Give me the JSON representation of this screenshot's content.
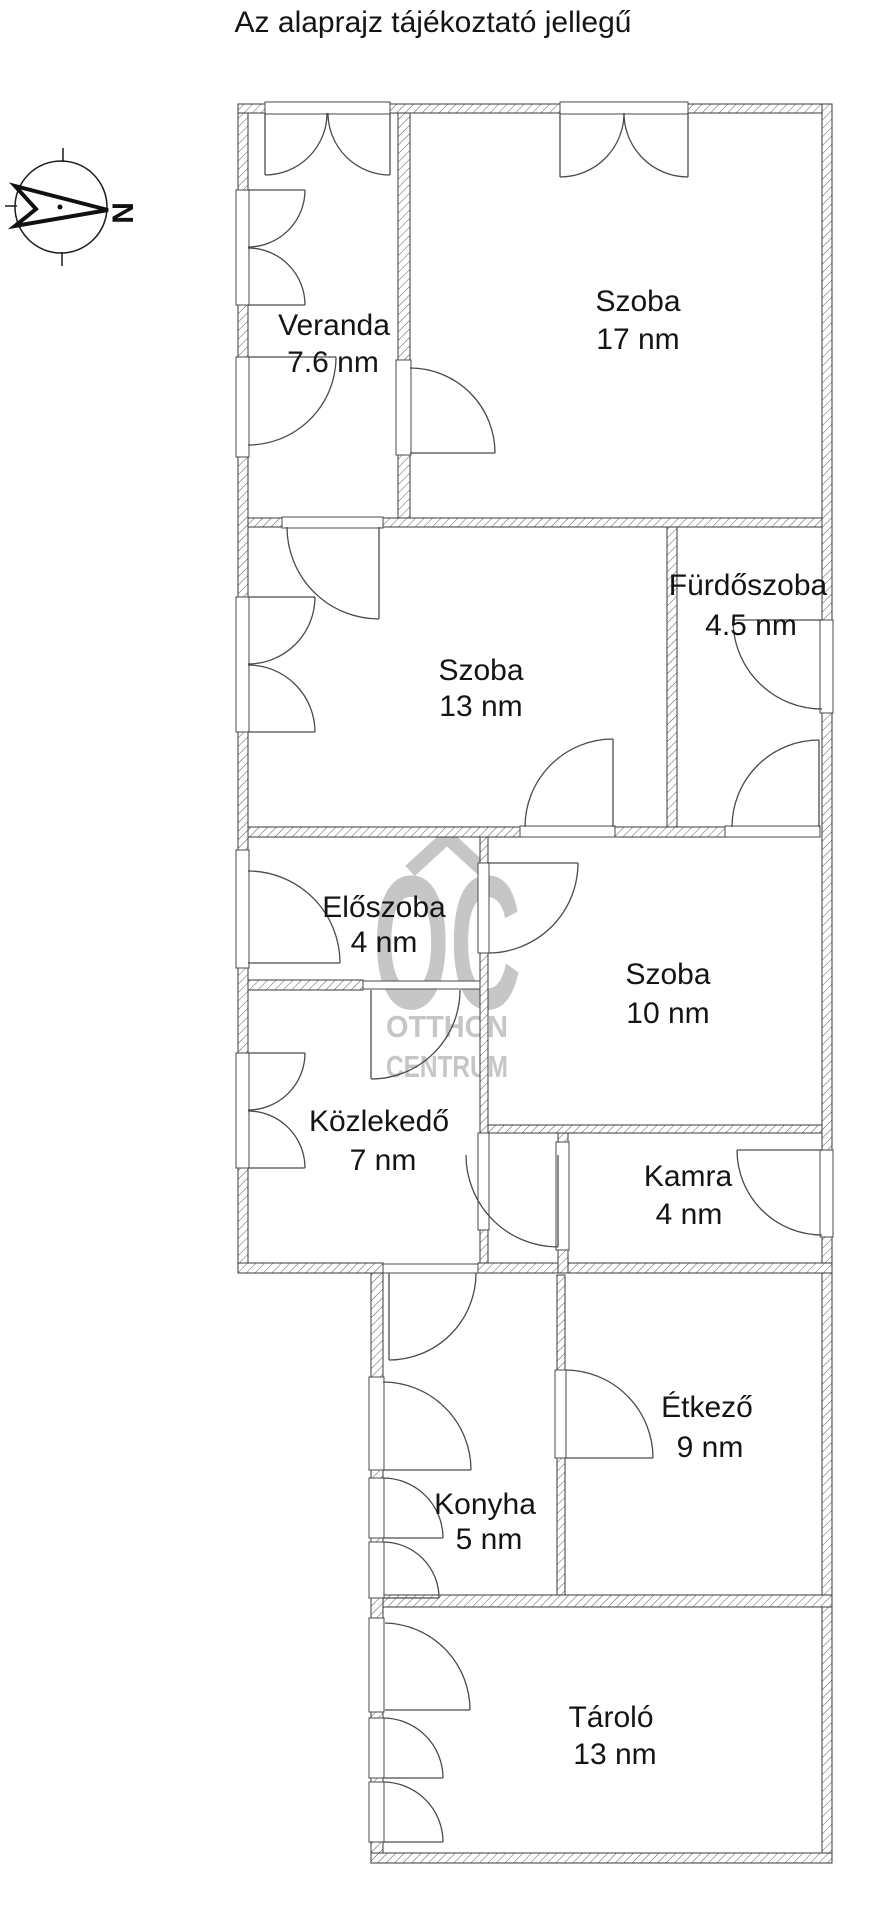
{
  "title": "Az alaprajz tájékoztató jellegű",
  "compass": {
    "direction_label": "N"
  },
  "watermark": {
    "logo": "OC",
    "line1": "OTTHON",
    "line2": "CENTRUM"
  },
  "rooms": [
    {
      "id": "veranda",
      "name": "Veranda",
      "area": "7.6 nm"
    },
    {
      "id": "szoba-17",
      "name": "Szoba",
      "area": "17 nm"
    },
    {
      "id": "szoba-13",
      "name": "Szoba",
      "area": "13 nm"
    },
    {
      "id": "furdoszoba",
      "name": "Fürdőszoba",
      "area": "4.5 nm"
    },
    {
      "id": "eloszoba",
      "name": "Előszoba",
      "area": "4 nm"
    },
    {
      "id": "szoba-10",
      "name": "Szoba",
      "area": "10 nm"
    },
    {
      "id": "kozlekedo",
      "name": "Közlekedő",
      "area": "7 nm"
    },
    {
      "id": "kamra",
      "name": "Kamra",
      "area": "4 nm"
    },
    {
      "id": "etkezo",
      "name": "Étkező",
      "area": "9 nm"
    },
    {
      "id": "konyha",
      "name": "Konyha",
      "area": "5 nm"
    },
    {
      "id": "tarolo",
      "name": "Tároló",
      "area": "13 nm"
    }
  ]
}
